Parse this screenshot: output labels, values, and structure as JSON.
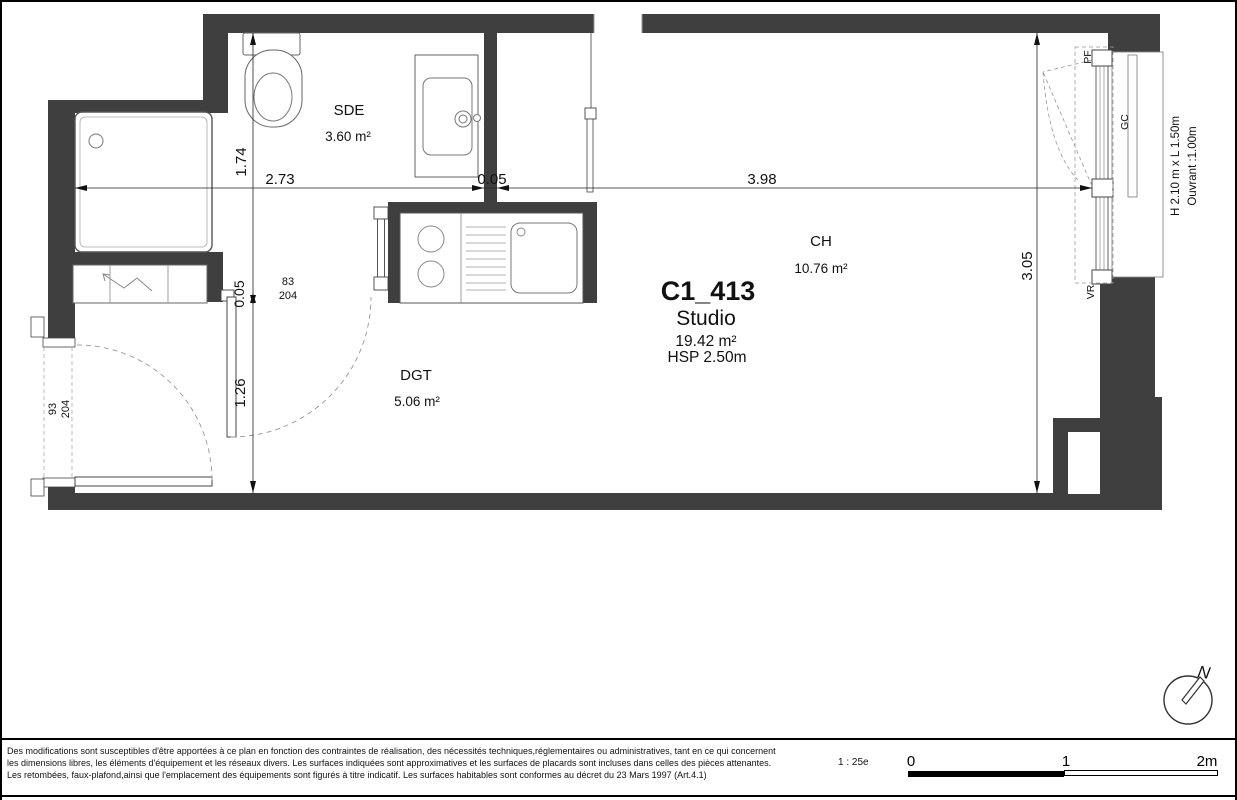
{
  "plan": {
    "title": {
      "id": "C1_413",
      "type": "Studio",
      "area": "19.42 m²",
      "height": "HSP 2.50m"
    },
    "rooms": [
      {
        "name": "SDE",
        "area": "3.60 m²"
      },
      {
        "name": "DGT",
        "area": "5.06 m²"
      },
      {
        "name": "CH",
        "area": "10.76 m²"
      }
    ],
    "dims": {
      "w_sde": "2.73",
      "w_wall": "0.05",
      "w_ch": "3.98",
      "h_sde": "1.74",
      "h_wall": "0.05",
      "h_entry": "1.26",
      "h_ch": "3.05"
    },
    "doors": {
      "entrance": {
        "width": "93",
        "height": "204"
      },
      "interior": {
        "width": "83",
        "height": "204"
      }
    },
    "window": {
      "pf": "PF",
      "gc": "GC",
      "vr": "VR",
      "size": "H 2.10 m x L 1.50m",
      "opening": "Ouvrant :1.00m"
    },
    "north_label": "N"
  },
  "footer": {
    "line1": "Des modifications sont susceptibles d'être apportées à ce plan en fonction des contraintes de réalisation, des nécessités techniques,réglementaires ou administratives, tant en ce qui concernent",
    "line2": "les dimensions libres, les éléments d'équipement et les réseaux divers. Les surfaces indiquées sont approximatives et les surfaces de placards sont incluses dans celles des pièces attenantes.",
    "line3": "Les retombées, faux-plafond,ainsi que l'emplacement des équipements sont figurés à titre indicatif. Les surfaces habitables sont conformes au décret du 23 Mars 1997 (Art.4.1)",
    "scale_label": "1 : 25e",
    "ticks": {
      "t0": "0",
      "t1": "1",
      "t2": "2m"
    }
  },
  "colors": {
    "wall": "#3f3f3f"
  }
}
